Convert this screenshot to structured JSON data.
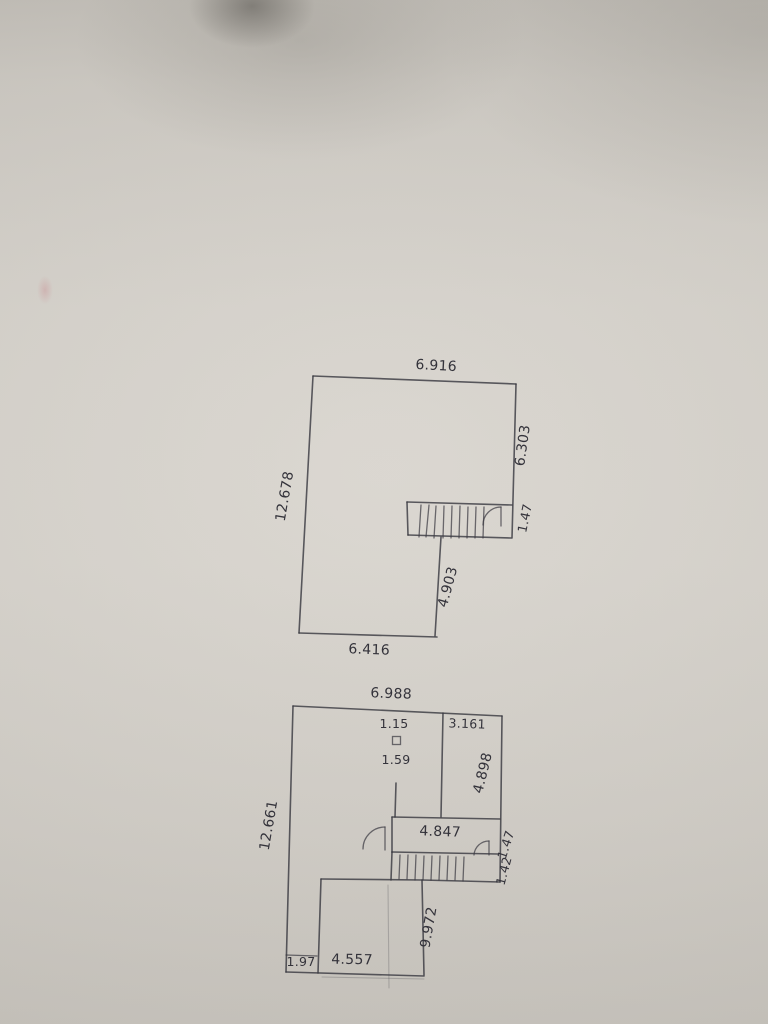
{
  "colors": {
    "paper": "#d4d0c9",
    "ink": "#3b3a42"
  },
  "upper_plan": {
    "width_top": "6.916",
    "height_left": "12.678",
    "height_right_upper": "6.303",
    "stair_depth": "1.47",
    "height_inner_lower": "4.903",
    "width_bottom": "6.416"
  },
  "lower_plan": {
    "width_top": "6.988",
    "dim_above_column": "1.15",
    "dim_below_column": "1.59",
    "right_room_width": "3.161",
    "right_room_height": "4.898",
    "height_left": "12.661",
    "landing_width": "4.847",
    "landing_depth": "1.47",
    "stair_depth": "1.42",
    "height_inner_lower": "9.972",
    "bottom_strip_width": "1.97",
    "bottom_room_width": "4.557"
  }
}
